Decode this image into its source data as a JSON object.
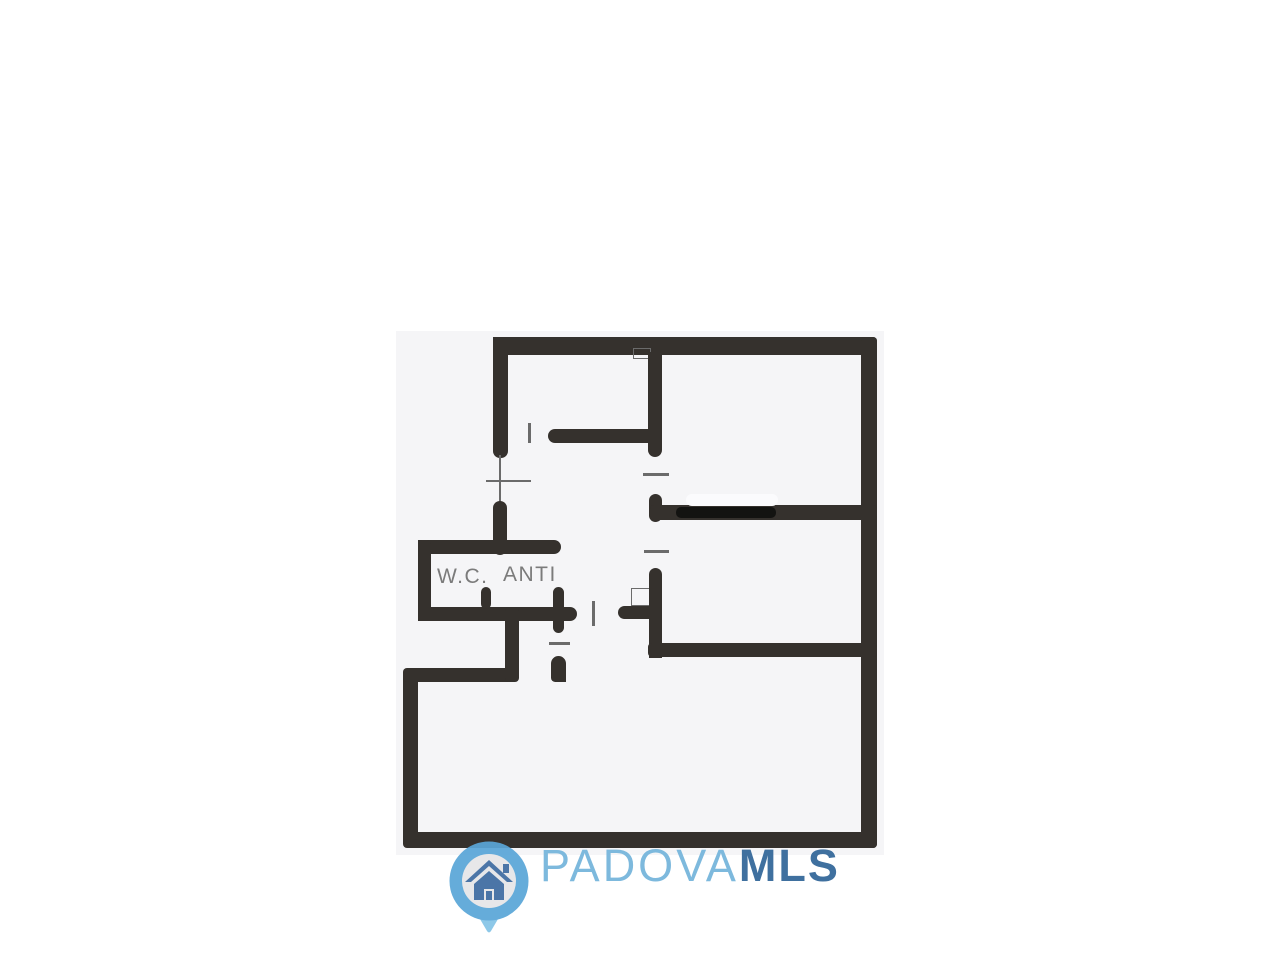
{
  "plan": {
    "labels": {
      "wc": "W.C.",
      "anti": "ANTI"
    }
  },
  "watermark": {
    "brand_primary": "PADOVA",
    "brand_secondary": "MLS"
  },
  "colors": {
    "page_bg": "#ffffff",
    "paper_color": "#f5f5f7",
    "wall_color": "#35312d",
    "line_color": "#6b6b6b",
    "label_color": "#7b7b7b",
    "brand_primary_color": "#7db9dd",
    "brand_secondary_color": "#3f709f",
    "pin_ring_color": "#5aa6d8",
    "pin_tail_color": "#85c4e7",
    "pin_inner_color": "#e6e6e8",
    "house_color": "#3e6ba1"
  }
}
